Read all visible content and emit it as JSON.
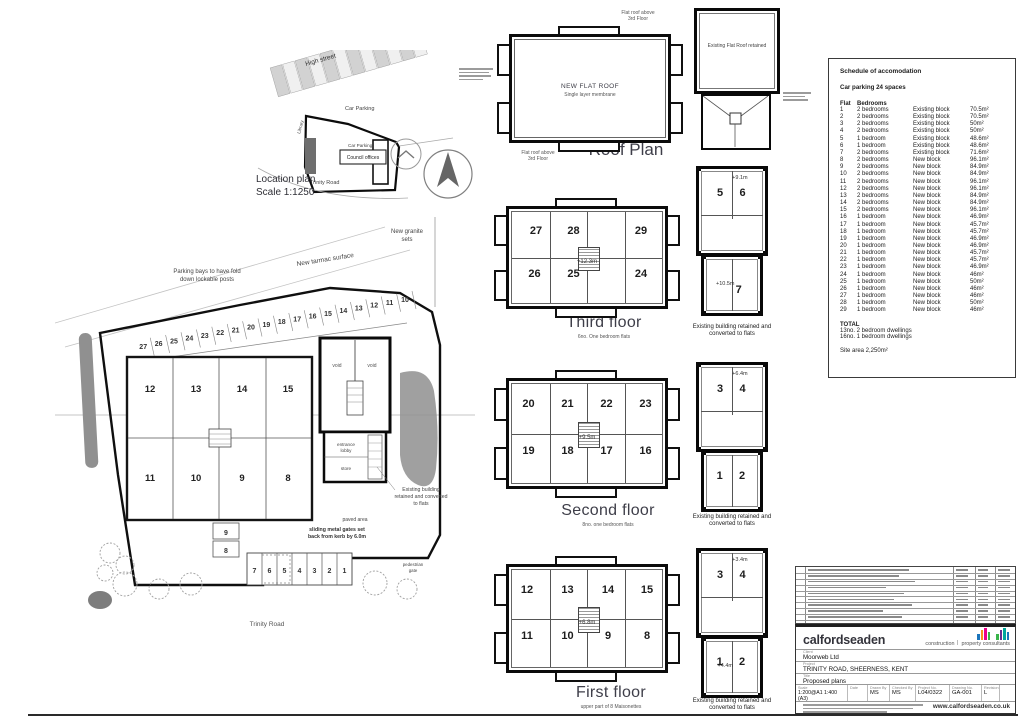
{
  "location_plan": {
    "caption": [
      "Location plan",
      "Scale 1:1250"
    ],
    "labels": {
      "high_street": "High street",
      "car_parking_a": "Car Parking",
      "car_parking_b": "Car Parking",
      "library": "Library",
      "council_offices": "Council offices",
      "trinity_road": "Trinity Road"
    }
  },
  "roof": {
    "caption": "Roof Plan",
    "center": [
      "NEW FLAT ROOF",
      "Single layer membrane"
    ],
    "ann": [
      [
        "Flat roof above",
        "3rd Floor"
      ],
      [
        "Flat roofs above",
        "2nd Floor"
      ],
      [
        "Flat roofs above",
        "2nd Floor"
      ],
      [
        "Flat roof above",
        "3rd Floor"
      ]
    ],
    "existing_label": "Existing Flat Roof retained"
  },
  "floor_captions": {
    "third": {
      "title": "Third floor",
      "subtitle": "6no. One bedroom flats"
    },
    "second": {
      "title": "Second floor",
      "subtitle": "8no. one bedroom flats"
    },
    "first": {
      "title": "First floor",
      "subtitle": "upper part of 8 Maisonettes"
    }
  },
  "new_block_floors": {
    "third": {
      "level": "+12.3m",
      "top": [
        "27",
        "28",
        "29"
      ],
      "top_x": [
        16,
        41,
        86
      ],
      "bottom": [
        "26",
        "25",
        "24"
      ],
      "bottom_x": [
        15,
        41,
        86
      ]
    },
    "second": {
      "level": "+9.5m",
      "top": [
        "20",
        "21",
        "22",
        "23"
      ],
      "top_x": [
        11,
        37,
        63,
        89
      ],
      "bottom": [
        "19",
        "18",
        "17",
        "16"
      ],
      "bottom_x": [
        11,
        37,
        63,
        89
      ]
    },
    "first": {
      "level": "+6.8m",
      "top": [
        "12",
        "13",
        "14",
        "15"
      ],
      "top_x": [
        10,
        37,
        64,
        90
      ],
      "bottom": [
        "11",
        "10",
        "9",
        "8"
      ],
      "bottom_x": [
        10,
        37,
        64,
        90
      ]
    }
  },
  "existing_floors": {
    "third": {
      "upper_level": "+9.1m",
      "upper": [
        "5",
        "6"
      ],
      "lower_level": "+10.5m",
      "lower": [
        "7"
      ],
      "caption": [
        "Existing building retained and",
        "converted to flats"
      ]
    },
    "second": {
      "upper_level": "+6.4m",
      "upper": [
        "3",
        "4"
      ],
      "lower_level": "",
      "lower": [
        "1",
        "2"
      ],
      "caption": [
        "Existing building retained and",
        "converted to flats"
      ]
    },
    "first": {
      "upper_level": "+3.4m",
      "upper": [
        "3",
        "4"
      ],
      "lower_level": "+4.4m",
      "lower": [
        "1",
        "2"
      ],
      "caption": [
        "Existing building retained and",
        "converted to flats"
      ]
    }
  },
  "site_plan": {
    "parking_top": [
      "10",
      "11",
      "12",
      "13",
      "14",
      "15",
      "16",
      "17",
      "18",
      "19",
      "20",
      "21",
      "22",
      "23",
      "24",
      "25",
      "26",
      "27"
    ],
    "parking_bottom": [
      "7",
      "6",
      "5",
      "4",
      "3",
      "2",
      "1"
    ],
    "parking_side": [
      "9",
      "8"
    ],
    "building_top": [
      "12",
      "13",
      "14",
      "15"
    ],
    "building_bottom": [
      "11",
      "10",
      "9",
      "8"
    ],
    "labels": {
      "granite": [
        "New granite",
        "sets"
      ],
      "tarmac": "New tarmac surface",
      "parking_note": [
        "Parking bays to have fold",
        "down lockable posts"
      ],
      "existing_note": [
        "Existing building",
        "retained and converted",
        "to flats"
      ],
      "gates_note": [
        "sliding metal gates set",
        "back from kerb by 6.0m"
      ],
      "trinity": "Trinity Road",
      "paved": "paved area",
      "void1": "void",
      "void2": "void",
      "lobby": [
        "entrance",
        "lobby"
      ],
      "store": "store",
      "ped_gate": [
        "pedestrian",
        "gate"
      ]
    }
  },
  "schedule": {
    "title": "Schedule of accomodation",
    "parking": "Car parking 24 spaces",
    "col_flat": "Flat",
    "col_bedrooms": "Bedrooms",
    "rows": [
      [
        "1",
        "2 bedrooms",
        "Existing block",
        "70.5m²"
      ],
      [
        "2",
        "2 bedrooms",
        "Existing block",
        "70.5m²"
      ],
      [
        "3",
        "2 bedrooms",
        "Existing block",
        "50m²"
      ],
      [
        "4",
        "2 bedrooms",
        "Existing block",
        "50m²"
      ],
      [
        "5",
        "1 bedroom",
        "Existing block",
        "48.6m²"
      ],
      [
        "6",
        "1 bedroom",
        "Existing block",
        "48.6m²"
      ],
      [
        "7",
        "2 bedrooms",
        "Existing block",
        "71.6m²"
      ],
      [
        "8",
        "2 bedrooms",
        "New block",
        "96.1m²"
      ],
      [
        "9",
        "2 bedrooms",
        "New block",
        "84.9m²"
      ],
      [
        "10",
        "2 bedrooms",
        "New block",
        "84.9m²"
      ],
      [
        "11",
        "2 bedrooms",
        "New block",
        "96.1m²"
      ],
      [
        "12",
        "2 bedrooms",
        "New block",
        "96.1m²"
      ],
      [
        "13",
        "2 bedrooms",
        "New block",
        "84.9m²"
      ],
      [
        "14",
        "2 bedrooms",
        "New block",
        "84.9m²"
      ],
      [
        "15",
        "2 bedrooms",
        "New block",
        "96.1m²"
      ],
      [
        "16",
        "1 bedroom",
        "New block",
        "46.9m²"
      ],
      [
        "17",
        "1 bedroom",
        "New block",
        "45.7m²"
      ],
      [
        "18",
        "1 bedroom",
        "New block",
        "45.7m²"
      ],
      [
        "19",
        "1 bedroom",
        "New block",
        "46.9m²"
      ],
      [
        "20",
        "1 bedroom",
        "New block",
        "46.9m²"
      ],
      [
        "21",
        "1 bedroom",
        "New block",
        "45.7m²"
      ],
      [
        "22",
        "1 bedroom",
        "New block",
        "45.7m²"
      ],
      [
        "23",
        "1 bedroom",
        "New block",
        "46.9m²"
      ],
      [
        "24",
        "1 bedroom",
        "New block",
        "46m²"
      ],
      [
        "25",
        "1 bedroom",
        "New block",
        "50m²"
      ],
      [
        "26",
        "1 bedroom",
        "New block",
        "46m²"
      ],
      [
        "27",
        "1 bedroom",
        "New block",
        "46m²"
      ],
      [
        "28",
        "1 bedroom",
        "New block",
        "50m²"
      ],
      [
        "29",
        "1 bedroom",
        "New block",
        "46m²"
      ]
    ],
    "total_title": "TOTAL",
    "totals": [
      "13no. 2 bedroom dwellings",
      "16no. 1 bedroom dwellings"
    ],
    "site_area": "Site area 2,250m²"
  },
  "title_block": {
    "firm": "calfordseaden",
    "tagline": [
      "construction",
      "property consultants"
    ],
    "client_label": "Client",
    "client": "Moorweb Ltd",
    "project_label": "Project",
    "project": "TRINITY ROAD, SHEERNESS, KENT",
    "title_label": "Title",
    "title": "Proposed plans",
    "fields": [
      {
        "label": "Scale",
        "value": "1:200@A1 1:400 (A3)"
      },
      {
        "label": "Date",
        "value": ""
      },
      {
        "label": "Drawn By",
        "value": "MS"
      },
      {
        "label": "Checked By",
        "value": "MS"
      },
      {
        "label": "Project No.",
        "value": "L04/0322"
      },
      {
        "label": "Drawing No.",
        "value": "GA-001"
      },
      {
        "label": "Revision",
        "value": "L"
      }
    ],
    "website": "www.calfordseaden.co.uk",
    "logo_colors": [
      "#1b75bc",
      "#f7941d",
      "#ec008c",
      "#39b54a",
      "#662d91",
      "#00a79d"
    ]
  }
}
